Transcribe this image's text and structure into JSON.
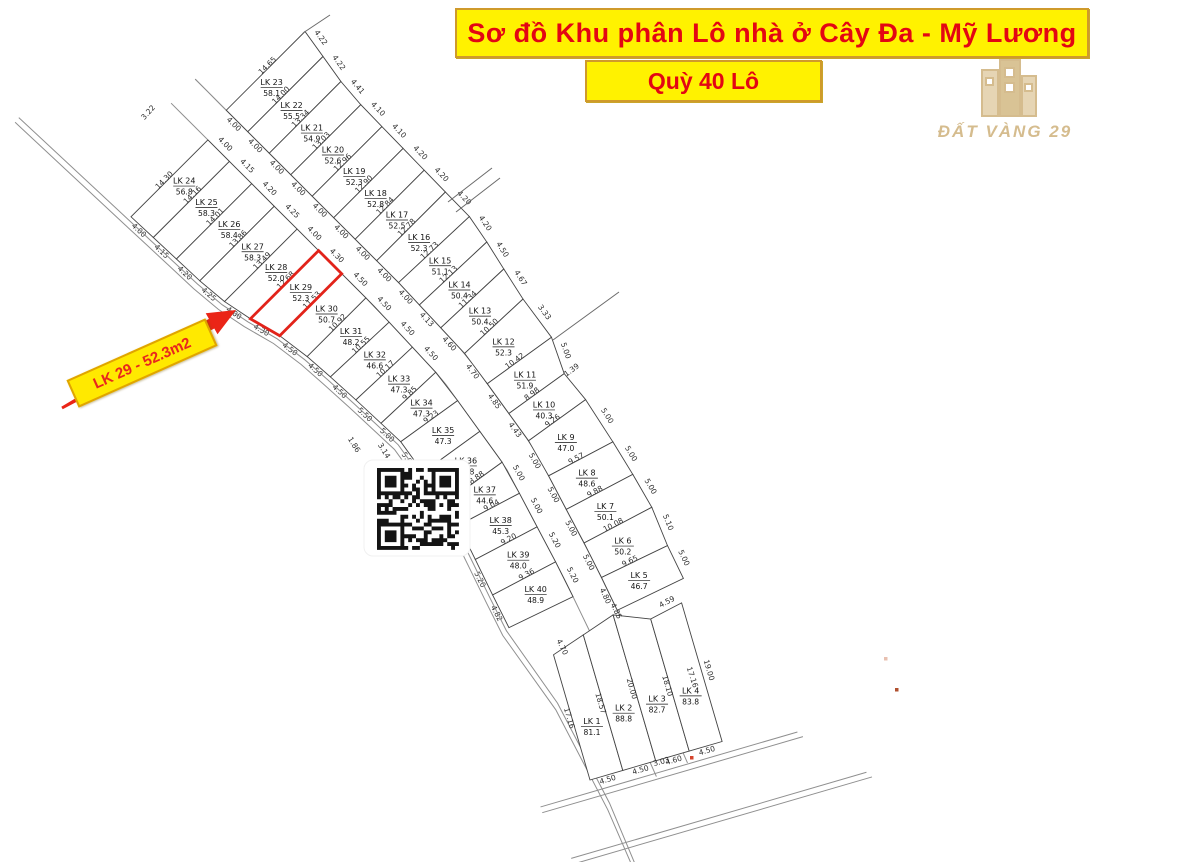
{
  "title_banner": {
    "text": "Sơ đồ Khu phân Lô nhà ở Cây Đa - Mỹ Lương"
  },
  "subtitle_banner": {
    "text": "Quỳ 40 Lô"
  },
  "logo": {
    "brand": "ĐẤT VÀNG 29"
  },
  "highlight_tag": {
    "text": "LK 29 - 52.3m2"
  },
  "colors": {
    "banner_bg": "#FFF200",
    "banner_text": "#E30613",
    "plot_line": "#444444",
    "road_line": "#8f8f8f",
    "highlight_red": "#E2231A",
    "logo_gold": "#D5BC8E",
    "dim_text": "#2e2e2e"
  },
  "map": {
    "right_strip": {
      "first_side": "14.65",
      "plots": [
        {
          "id": "LK 23",
          "area": "58.1",
          "front": "4.00",
          "back": "4.22",
          "side": "14.00"
        },
        {
          "id": "LK 22",
          "area": "55.5",
          "front": "4.00",
          "back": "4.22",
          "side": "13.34"
        },
        {
          "id": "LK 21",
          "area": "54.9",
          "front": "4.00",
          "back": "4.41",
          "side": "13.03"
        },
        {
          "id": "LK 20",
          "area": "52.6",
          "front": "4.00",
          "back": "4.10",
          "side": "12.96"
        },
        {
          "id": "LK 19",
          "area": "52.3",
          "front": "4.00",
          "back": "4.10",
          "side": "12.90"
        },
        {
          "id": "LK 18",
          "area": "52.8",
          "front": "4.00",
          "back": "4.20",
          "side": "12.84"
        },
        {
          "id": "LK 17",
          "area": "52.5",
          "front": "4.00",
          "back": "4.20",
          "side": "12.78"
        },
        {
          "id": "LK 16",
          "area": "52.3",
          "front": "4.00",
          "back": "4.20",
          "side": "12.73"
        },
        {
          "id": "LK 15",
          "area": "51.1",
          "front": "4.00",
          "back": "4.20",
          "side": "12.13"
        },
        {
          "id": "LK 14",
          "area": "50.4",
          "front": "4.13",
          "back": "4.50",
          "side": "11.34"
        },
        {
          "id": "LK 13",
          "area": "50.4",
          "front": "4.60",
          "back": "4.67",
          "side": "10.50"
        },
        {
          "id": "LK 12",
          "area": "52.3",
          "front": "4.70",
          "back": "3.33",
          "side": "10.42"
        },
        {
          "id": "LK 11",
          "area": "51.9",
          "front": "4.85",
          "back": "5.00",
          "side": "8.98"
        },
        {
          "id": "LK 10",
          "area": "40.3",
          "front": "4.43",
          "side": "9.26"
        },
        {
          "id": "LK 9",
          "area": "47.0",
          "front": "5.00",
          "back": "5.00",
          "side": "9.57"
        },
        {
          "id": "LK 8",
          "area": "48.6",
          "front": "5.00",
          "back": "5.00",
          "side": "9.88"
        },
        {
          "id": "LK 7",
          "area": "50.1",
          "front": "5.00",
          "back": "5.00",
          "side": "10.08"
        },
        {
          "id": "LK 6",
          "area": "50.2",
          "front": "5.00",
          "back": "5.10",
          "side": "9.65"
        },
        {
          "id": "LK 5",
          "area": "46.7",
          "front": "4.80",
          "back": "5.00"
        }
      ]
    },
    "bottom_block": {
      "right_side": "19.00",
      "plots": [
        {
          "id": "LK 1",
          "area": "81.1",
          "front": "4.50",
          "side": "17.16"
        },
        {
          "id": "LK 2",
          "area": "88.8",
          "front": "4.50",
          "side": "18.57"
        },
        {
          "id": "LK 3",
          "area": "82.7",
          "front": "4.60",
          "side": "20.00"
        },
        {
          "id": "LK 4",
          "area": "83.8",
          "front": "4.50",
          "side": "18.10"
        }
      ]
    },
    "left_strip": {
      "first_side": "14.30",
      "plots": [
        {
          "id": "LK 24",
          "area": "56.8",
          "front": "4.00",
          "back": "4.00",
          "side": "14.16"
        },
        {
          "id": "LK 25",
          "area": "58.3",
          "front": "4.15",
          "back": "4.15",
          "side": "14.01"
        },
        {
          "id": "LK 26",
          "area": "58.4",
          "front": "4.20",
          "back": "4.20",
          "side": "13.86"
        },
        {
          "id": "LK 27",
          "area": "58.3",
          "front": "4.25",
          "back": "4.25",
          "side": "13.49"
        },
        {
          "id": "LK 28",
          "area": "52.0",
          "front": "4.00",
          "back": "4.00",
          "side": "12.68"
        },
        {
          "id": "LK 29",
          "area": "52.3",
          "front": "4.30",
          "back": "4.30",
          "side": "11.53",
          "highlight": true
        },
        {
          "id": "LK 30",
          "area": "50.7",
          "front": "4.50",
          "back": "4.50",
          "side": "10.92"
        },
        {
          "id": "LK 31",
          "area": "48.2",
          "front": "4.50",
          "back": "4.50",
          "side": "10.55"
        },
        {
          "id": "LK 32",
          "area": "46.6",
          "front": "4.50",
          "back": "4.50",
          "side": "10.17"
        },
        {
          "id": "LK 33",
          "area": "47.3",
          "front": "4.50",
          "back": "5.50",
          "side": "9.85"
        },
        {
          "id": "LK 34",
          "area": "47.3",
          "back": "5.00",
          "side": "9.23"
        },
        {
          "id": "LK 35",
          "area": "47.3",
          "back": "5.00"
        },
        {
          "id": "LK 36",
          "area": "44.8",
          "back": "5.00",
          "side": "8.88"
        },
        {
          "id": "LK 37",
          "area": "44.6",
          "front": "5.00",
          "back": "5.00",
          "side": "9.04"
        },
        {
          "id": "LK 38",
          "area": "45.3",
          "front": "5.00",
          "back": "5.00",
          "side": "9.20"
        },
        {
          "id": "LK 39",
          "area": "48.0",
          "front": "5.20",
          "back": "5.20",
          "side": "9.36"
        },
        {
          "id": "LK 40",
          "area": "48.9",
          "front": "5.20",
          "back": "4.82"
        }
      ]
    },
    "stray_labels": [
      {
        "text": "3.22",
        "x": 150,
        "y": 114,
        "rot": -48
      },
      {
        "text": "1.39",
        "x": 573,
        "y": 372,
        "rot": -36
      },
      {
        "text": "1.86",
        "x": 352,
        "y": 446,
        "rot": 58
      },
      {
        "text": "3.14",
        "x": 382,
        "y": 452,
        "rot": 58
      },
      {
        "text": "4.85",
        "x": 614,
        "y": 612,
        "rot": 64
      },
      {
        "text": "4.59",
        "x": 668,
        "y": 604,
        "rot": -28
      },
      {
        "text": "17.16",
        "x": 690,
        "y": 678,
        "rot": 72
      },
      {
        "text": "3.03",
        "x": 662,
        "y": 764,
        "rot": -16
      },
      {
        "text": "4.70",
        "x": 560,
        "y": 648,
        "rot": 64
      }
    ]
  }
}
